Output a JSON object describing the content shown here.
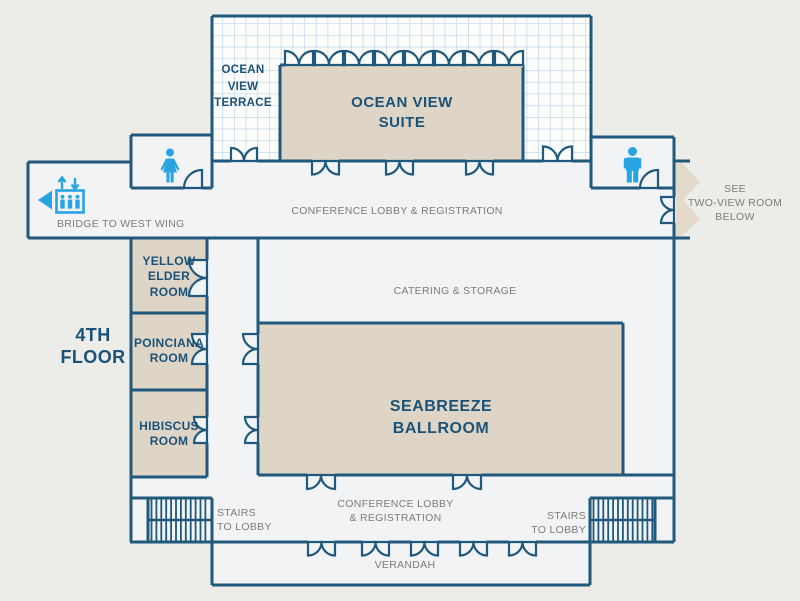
{
  "palette": {
    "background": "#ECECE8",
    "floor": "#F1F3F5",
    "wall": "#20597C",
    "room_fill": "#DFD5C7",
    "terrace_white": "#FDFDFC",
    "grid_line": "#B7D2E9",
    "accent_blue": "#29A4E2",
    "gray_text": "#7B7B7B",
    "dark_blue_text": "#1B5278"
  },
  "floor_label": "4TH\nFLOOR",
  "areas": {
    "terrace": {
      "label": "OCEAN\nVIEW\nTERRACE"
    },
    "suite": {
      "label": "OCEAN VIEW\nSUITE"
    },
    "lobby_top": {
      "label": "CONFERENCE LOBBY & REGISTRATION"
    },
    "bridge": {
      "label": "BRIDGE TO WEST WING",
      "icons": [
        "elevator-people-icon",
        "up-down-arrows-icon",
        "arrow-left-icon"
      ]
    },
    "two_view_note": {
      "label": "SEE\nTWO-VIEW ROOM\nBELOW",
      "icon": "chevron-ribbon-right-icon"
    },
    "yellow_elder": {
      "label": "YELLOW\nELDER\nROOM"
    },
    "poinciana": {
      "label": "POINCIANA\nROOM"
    },
    "hibiscus": {
      "label": "HIBISCUS\nROOM"
    },
    "catering": {
      "label": "CATERING & STORAGE"
    },
    "ballroom": {
      "label": "SEABREEZE\nBALLROOM"
    },
    "lobby_bottom": {
      "label": "CONFERENCE LOBBY\n& REGISTRATION"
    },
    "stairs_left": {
      "label": "STAIRS\nTO LOBBY",
      "icon": "stairs-hatch-icon"
    },
    "stairs_right": {
      "label": "STAIRS\nTO LOBBY",
      "icon": "stairs-hatch-icon"
    },
    "verandah": {
      "label": "VERANDAH"
    },
    "restroom_women": {
      "icon": "woman-icon"
    },
    "restroom_men": {
      "icon": "man-icon"
    }
  }
}
